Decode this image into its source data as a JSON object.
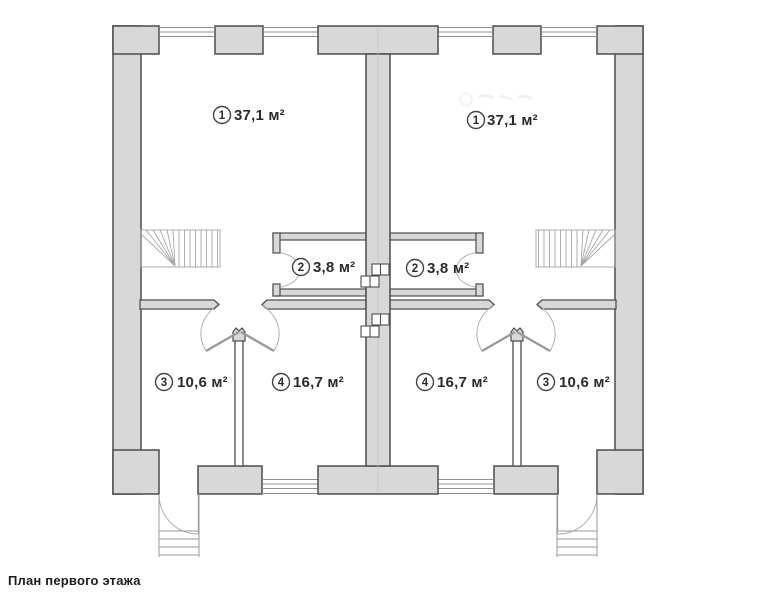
{
  "caption": "План первого этажа",
  "plan": {
    "units": [
      {
        "name": "left-unit",
        "rooms": [
          {
            "num": "1",
            "area": "37,1 м²"
          },
          {
            "num": "2",
            "area": "3,8 м²"
          },
          {
            "num": "3",
            "area": "10,6 м²"
          },
          {
            "num": "4",
            "area": "16,7 м²"
          }
        ]
      },
      {
        "name": "right-unit",
        "rooms": [
          {
            "num": "1",
            "area": "37,1 м²"
          },
          {
            "num": "2",
            "area": "3,8 м²"
          },
          {
            "num": "3",
            "area": "10,6 м²"
          },
          {
            "num": "4",
            "area": "16,7 м²"
          }
        ]
      }
    ]
  },
  "colors": {
    "background": "#ffffff",
    "wall_fill": "#d8d8d8",
    "wall_stroke": "#4d4d4d",
    "thin_line": "#909090",
    "stair_line": "#a6a6a6",
    "door_arc": "#b0b0b0",
    "label_text": "#2b2b2b",
    "caption_text": "#1c1c1c"
  }
}
